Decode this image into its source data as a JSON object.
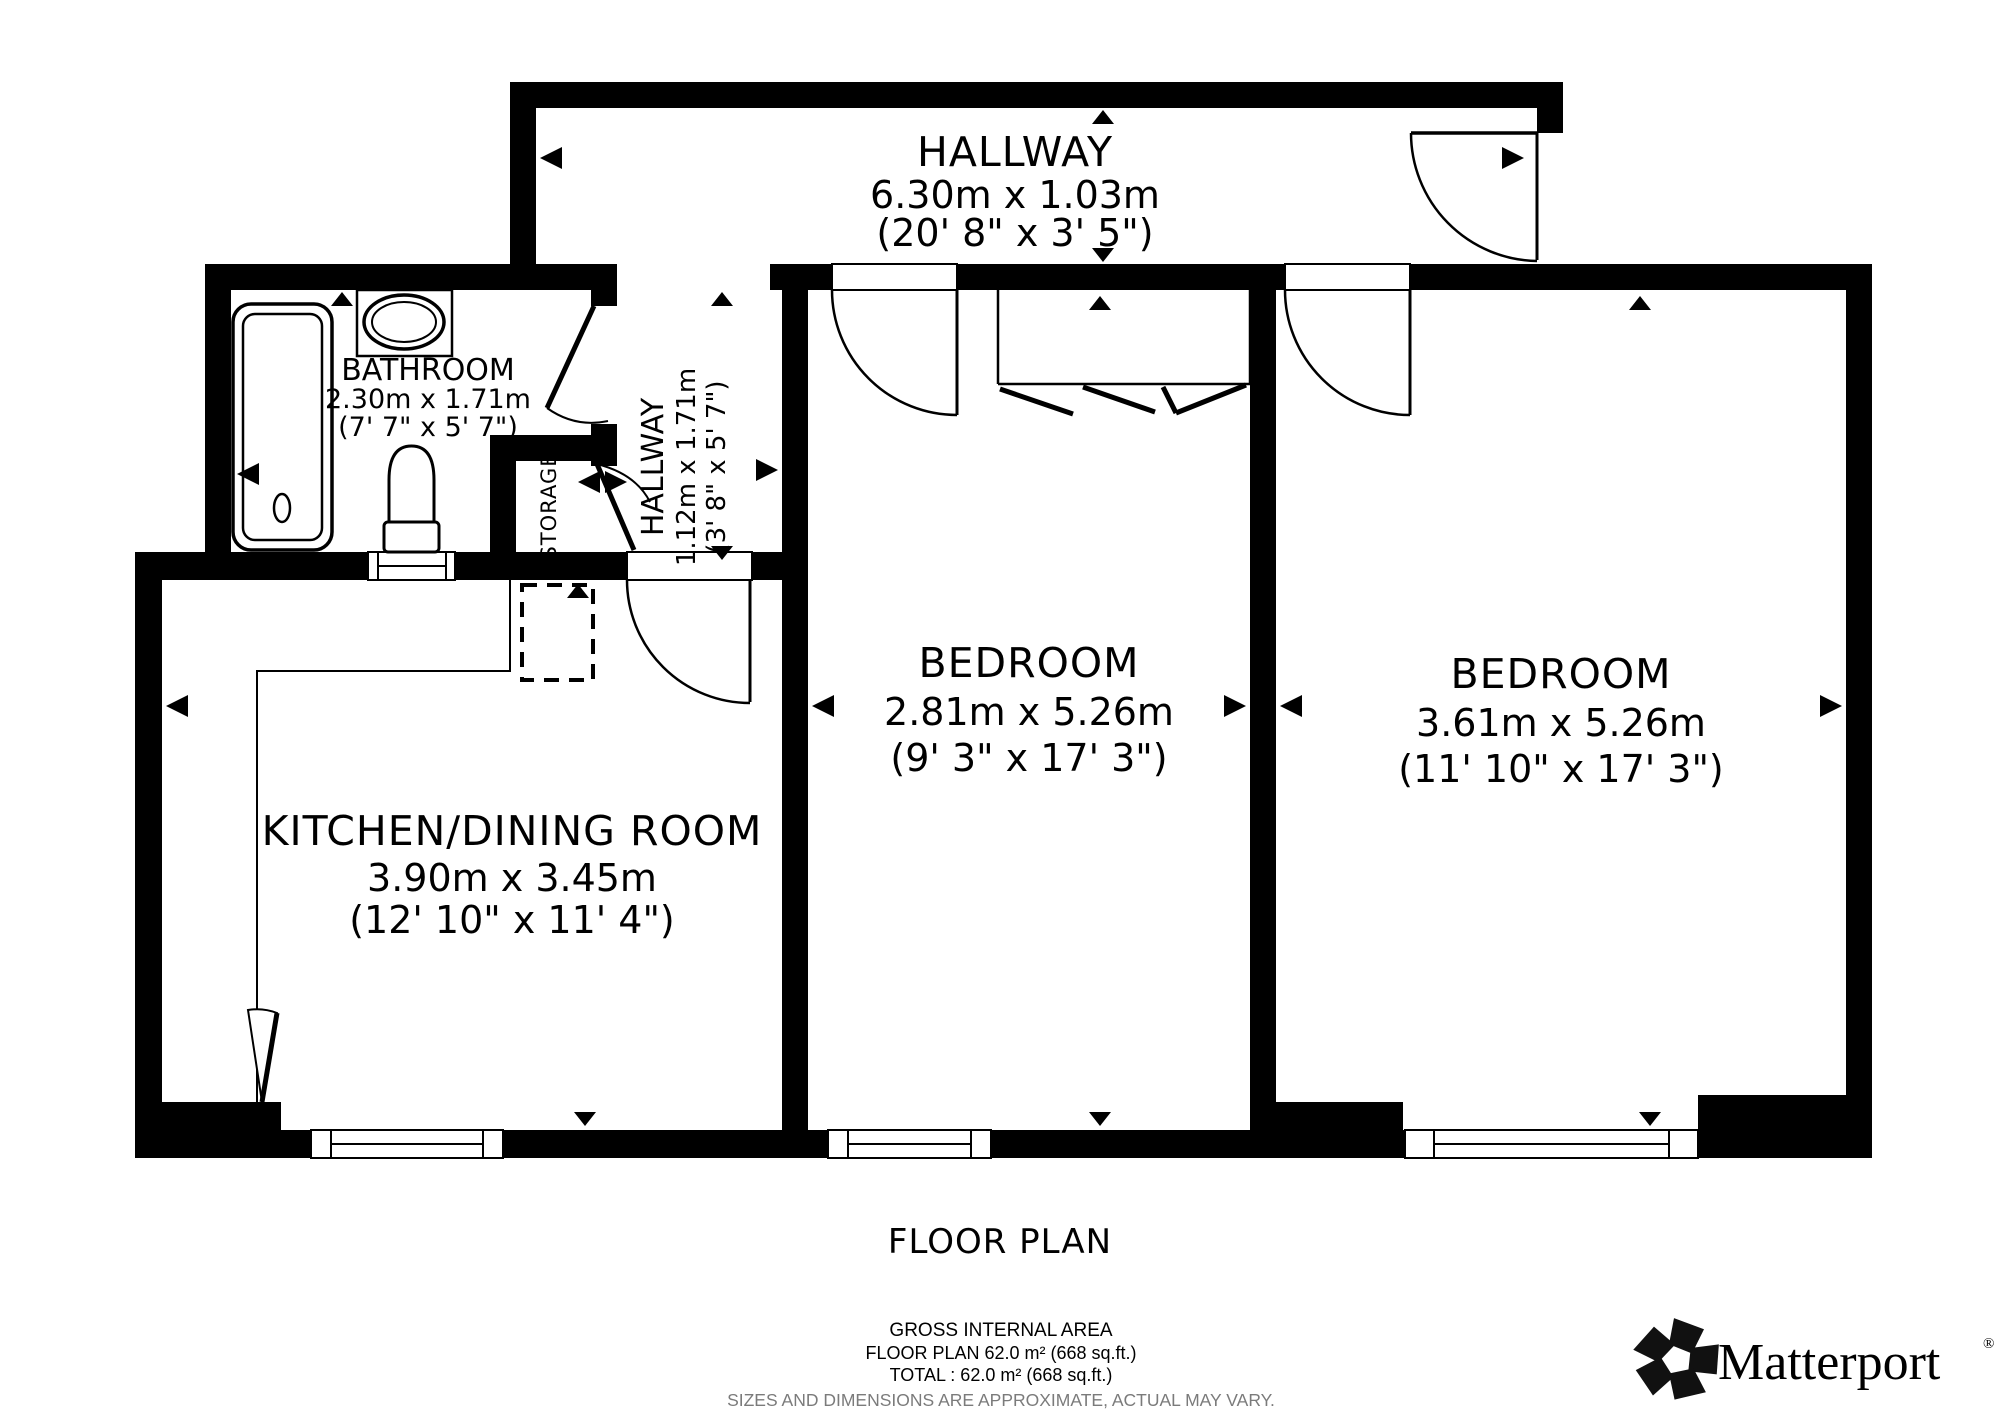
{
  "floorplan": {
    "title": "FLOOR PLAN",
    "rooms": {
      "hallway_top": {
        "label": "HALLWAY",
        "metric": "6.30m x 1.03m",
        "imperial": "(20' 8\" x 3' 5\")"
      },
      "bathroom": {
        "label": "BATHROOM",
        "metric": "2.30m x 1.71m",
        "imperial": "(7' 7\" x 5' 7\")"
      },
      "hallway_inner": {
        "label": "HALLWAY",
        "metric": "1.12m x 1.71m",
        "imperial": "(3' 8\" x 5' 7\")"
      },
      "storage": {
        "label": "STORAGE"
      },
      "bedroom_middle": {
        "label": "BEDROOM",
        "metric": "2.81m x 5.26m",
        "imperial": "(9' 3\" x 17' 3\")"
      },
      "bedroom_right": {
        "label": "BEDROOM",
        "metric": "3.61m x 5.26m",
        "imperial": "(11' 10\" x 17' 3\")"
      },
      "kitchen": {
        "label": "KITCHEN/DINING ROOM",
        "metric": "3.90m x 3.45m",
        "imperial": "(12' 10\" x 11' 4\")"
      }
    },
    "footer": {
      "area_title": "GROSS INTERNAL AREA",
      "area_floor": "FLOOR PLAN 62.0 m² (668 sq.ft.)",
      "area_total": "TOTAL :  62.0 m² (668 sq.ft.)",
      "disclaimer": "SIZES AND DIMENSIONS ARE APPROXIMATE, ACTUAL MAY VARY."
    },
    "branding": {
      "name": "Matterport",
      "registered": "®"
    },
    "colors": {
      "wall": "#000000",
      "background": "#ffffff",
      "disclaimer_gray": "#7b7b7b"
    }
  }
}
